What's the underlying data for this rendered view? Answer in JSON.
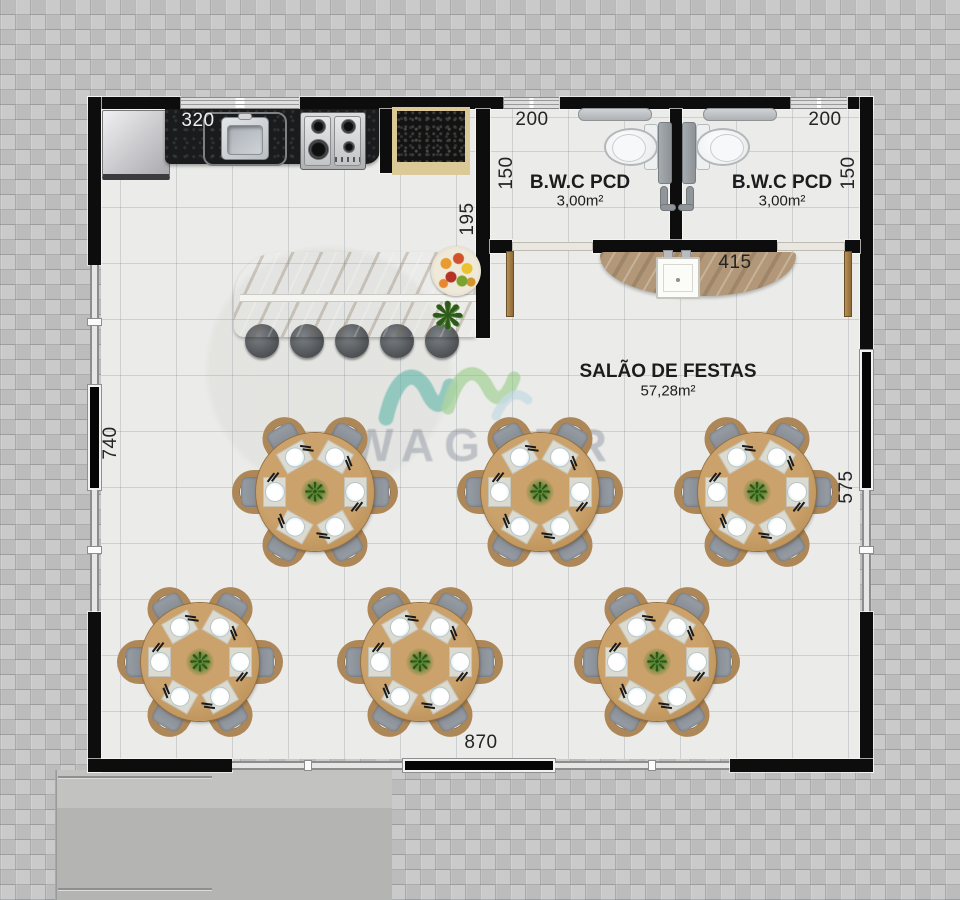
{
  "plan": {
    "title": "Floor plan - party hall with kitchen and accessible bathrooms",
    "rooms": [
      {
        "name": "B.W.C PCD",
        "area": "3,00m²"
      },
      {
        "name": "B.W.C PCD",
        "area": "3,00m²"
      },
      {
        "name": "SALÃO DE FESTAS",
        "area": "57,28m²"
      }
    ],
    "dimensions": {
      "kitchen_counter": "320",
      "bwc1_width": "200",
      "bwc2_width": "200",
      "bwc1_depth": "150",
      "bwc2_depth": "150",
      "kitchen_wall": "195",
      "vanity_wall": "415",
      "left_wall": "740",
      "right_wall": "575",
      "bottom_wall": "870"
    },
    "watermark": {
      "text": "WAGNER"
    },
    "colors": {
      "wall": "#0d0d0e",
      "wood_chair": "#ad8757",
      "table_wood": "#c49a62",
      "seat_gray": "#8b9096",
      "bar_granite": "#c0ae94",
      "vanity_granite": "#b29879",
      "watermark_teal": "#52b3a4",
      "watermark_green": "#7cc26a"
    },
    "furniture": {
      "dining_tables": [
        {
          "cx": 315,
          "cy": 492
        },
        {
          "cx": 540,
          "cy": 492
        },
        {
          "cx": 757,
          "cy": 492
        },
        {
          "cx": 200,
          "cy": 662
        },
        {
          "cx": 420,
          "cy": 662
        },
        {
          "cx": 657,
          "cy": 662
        }
      ],
      "chairs_per_table": 6,
      "place_settings_per_table": 6,
      "bar_stools": 5,
      "bathrooms": 2
    }
  }
}
